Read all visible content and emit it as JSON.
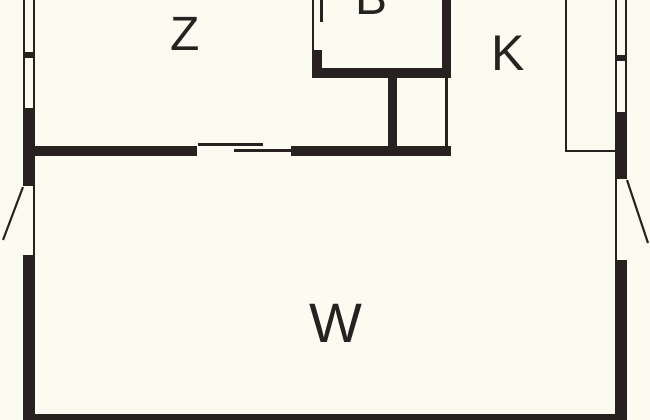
{
  "title": "Floor plan",
  "colors": {
    "background": "#fbfbf2",
    "line": "#272220"
  },
  "rooms": [
    {
      "id": "Z",
      "label": "Z"
    },
    {
      "id": "B",
      "label": "B"
    },
    {
      "id": "K",
      "label": "K"
    },
    {
      "id": "W",
      "label": "W"
    }
  ]
}
